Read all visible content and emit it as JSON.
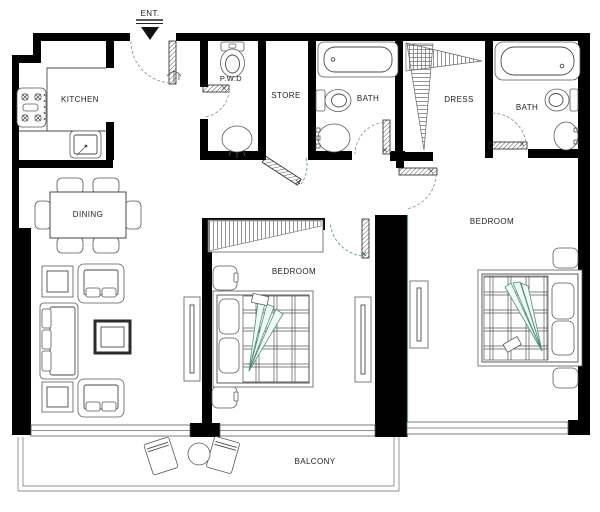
{
  "plan": {
    "labels": {
      "entrance": "ENT.",
      "kitchen": "KITCHEN",
      "pwd": "P.W.D",
      "store": "STORE",
      "bath1": "BATH",
      "dress": "DRESS",
      "bath2": "BATH",
      "dining": "DINING",
      "bedroom1": "BEDROOM",
      "bedroom2": "BEDROOM",
      "balcony": "BALCONY"
    },
    "colors": {
      "wall": "#000000",
      "line": "#4a4a4a",
      "accent_green": "#5f9e8a",
      "background": "#ffffff",
      "text": "#1f1f1f"
    }
  }
}
